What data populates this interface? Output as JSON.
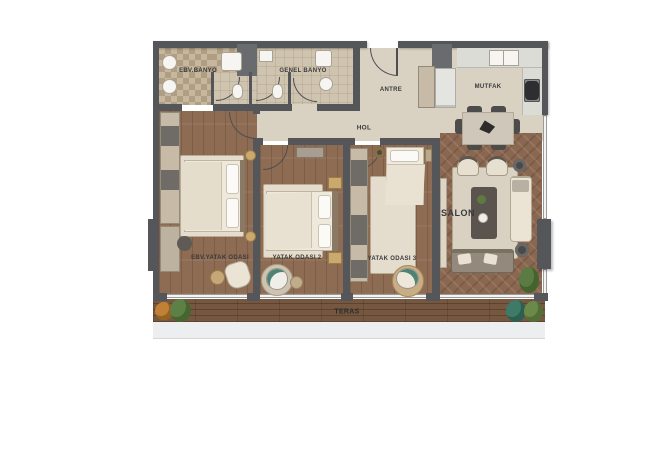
{
  "plan": {
    "rooms": {
      "ebv_banyo": "EBV.BANYO",
      "genel_banyo": "GENEL BANYO",
      "antre": "ANTRE",
      "mutfak": "MUTFAK",
      "hol": "HOL",
      "ebv_yatak_odasi": "EBV.YATAK ODASI",
      "yatak_odasi_2": "YATAK ODASI 2",
      "yatak_odasi_3": "YATAK ODASI 3",
      "salon": "SALON",
      "teras": "TERAS"
    },
    "colors": {
      "wall": "#55565a",
      "wood_floor": "#8d6c53",
      "herringbone_floor": "#8a6750",
      "tile_floor": "#cfc4af",
      "hall_floor": "#d9d2c2",
      "deck_floor": "#765740",
      "label_text": "#3a3a3c"
    }
  }
}
